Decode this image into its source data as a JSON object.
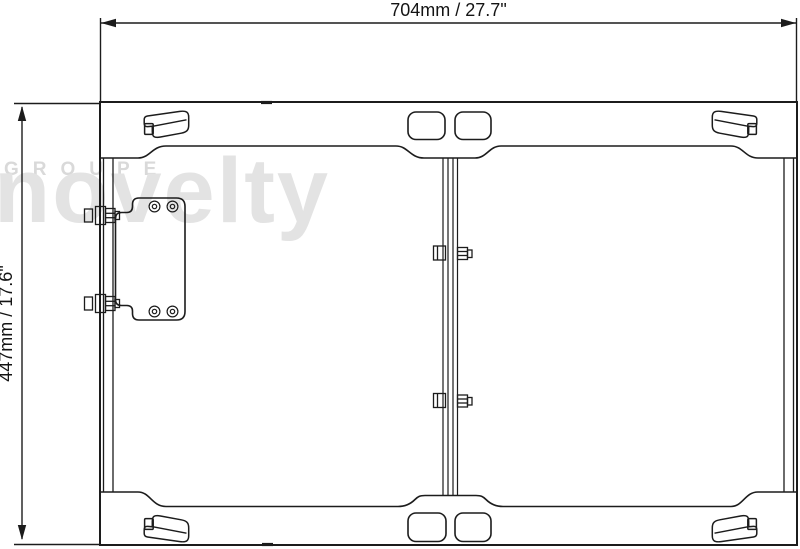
{
  "dimensions": {
    "width_label": "704mm / 27.7\"",
    "height_label": "447mm / 17.6\""
  },
  "watermark": {
    "brand_small": "GROUPE",
    "brand_large": "novelty"
  },
  "colors": {
    "line": "#1c1c1c",
    "watermark_large": "#e3e3e3",
    "watermark_small": "#d9d9d9",
    "background": "#ffffff"
  }
}
